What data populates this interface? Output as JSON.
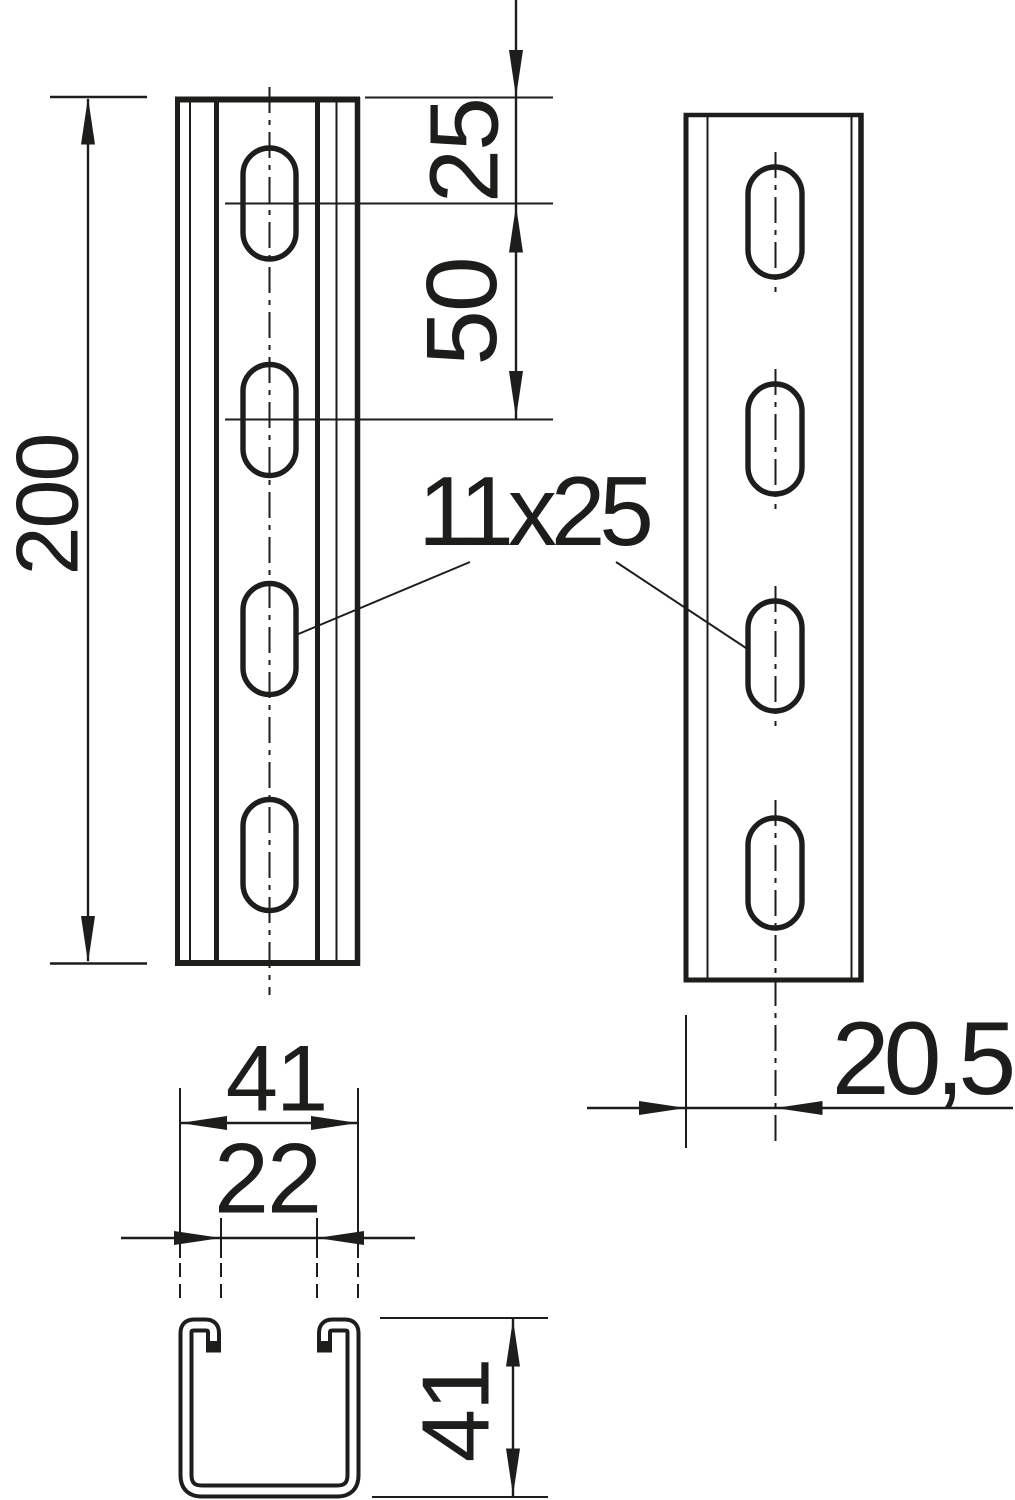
{
  "drawing": {
    "colors": {
      "line": "#1d1d1b",
      "background": "#ffffff"
    },
    "dimensions": {
      "rail_length": {
        "label": "200"
      },
      "first_hole_offset": {
        "label": "25"
      },
      "hole_pitch": {
        "label": "50"
      },
      "slot_size": {
        "label": "11x25"
      },
      "profile_width": {
        "label": "41"
      },
      "opening_width": {
        "label": "22"
      },
      "profile_height": {
        "label": "41"
      },
      "center_offset": {
        "label": "20,5"
      }
    }
  }
}
